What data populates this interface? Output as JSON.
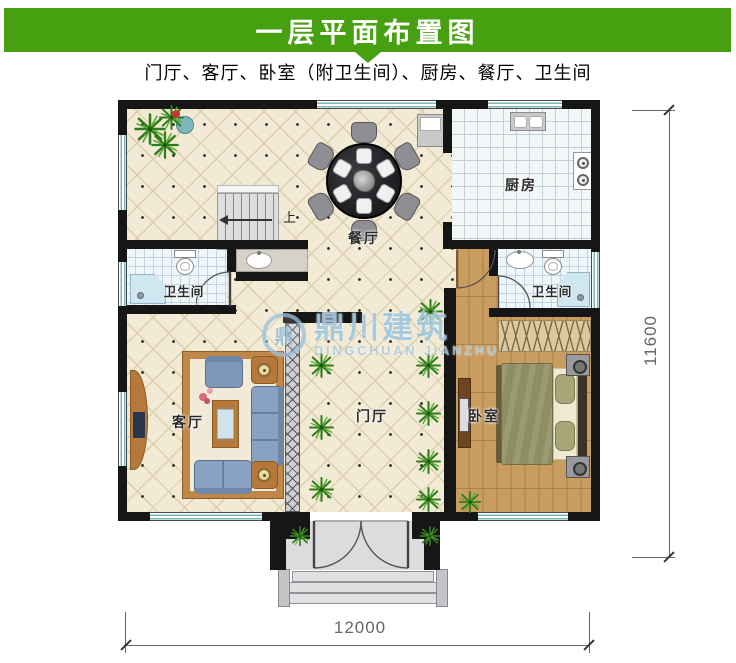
{
  "header": {
    "title": "一层平面布置图",
    "subtitle": "门厅、客厅、卧室（附卫生间）、厨房、餐厅、卫生间"
  },
  "rooms": {
    "dining": {
      "label": "餐厅"
    },
    "kitchen": {
      "label": "厨房"
    },
    "bath_left": {
      "label": "卫生间"
    },
    "bath_right": {
      "label": "卫生间"
    },
    "living": {
      "label": "客厅"
    },
    "hall": {
      "label": "门厅"
    },
    "bedroom": {
      "label": "卧室"
    }
  },
  "stairs": {
    "direction_label": "上"
  },
  "dimensions": {
    "bottom_width_mm": "12000",
    "right_height_mm": "11600"
  },
  "watermark": {
    "logo_glyph": "鼎",
    "brand": "鼎川建筑",
    "brand_latin": "DINGCHUAN JIANZHU"
  },
  "colors": {
    "banner_green": "#46a00f",
    "wall_black": "#161616",
    "window_teal": "#79b7b4",
    "floor_cream": "#f2ead5",
    "wood_floor": "#c99c60",
    "sofa_blue": "#8098b8",
    "watermark_blue": "#9bc3da",
    "dimension_gray": "#666666"
  }
}
